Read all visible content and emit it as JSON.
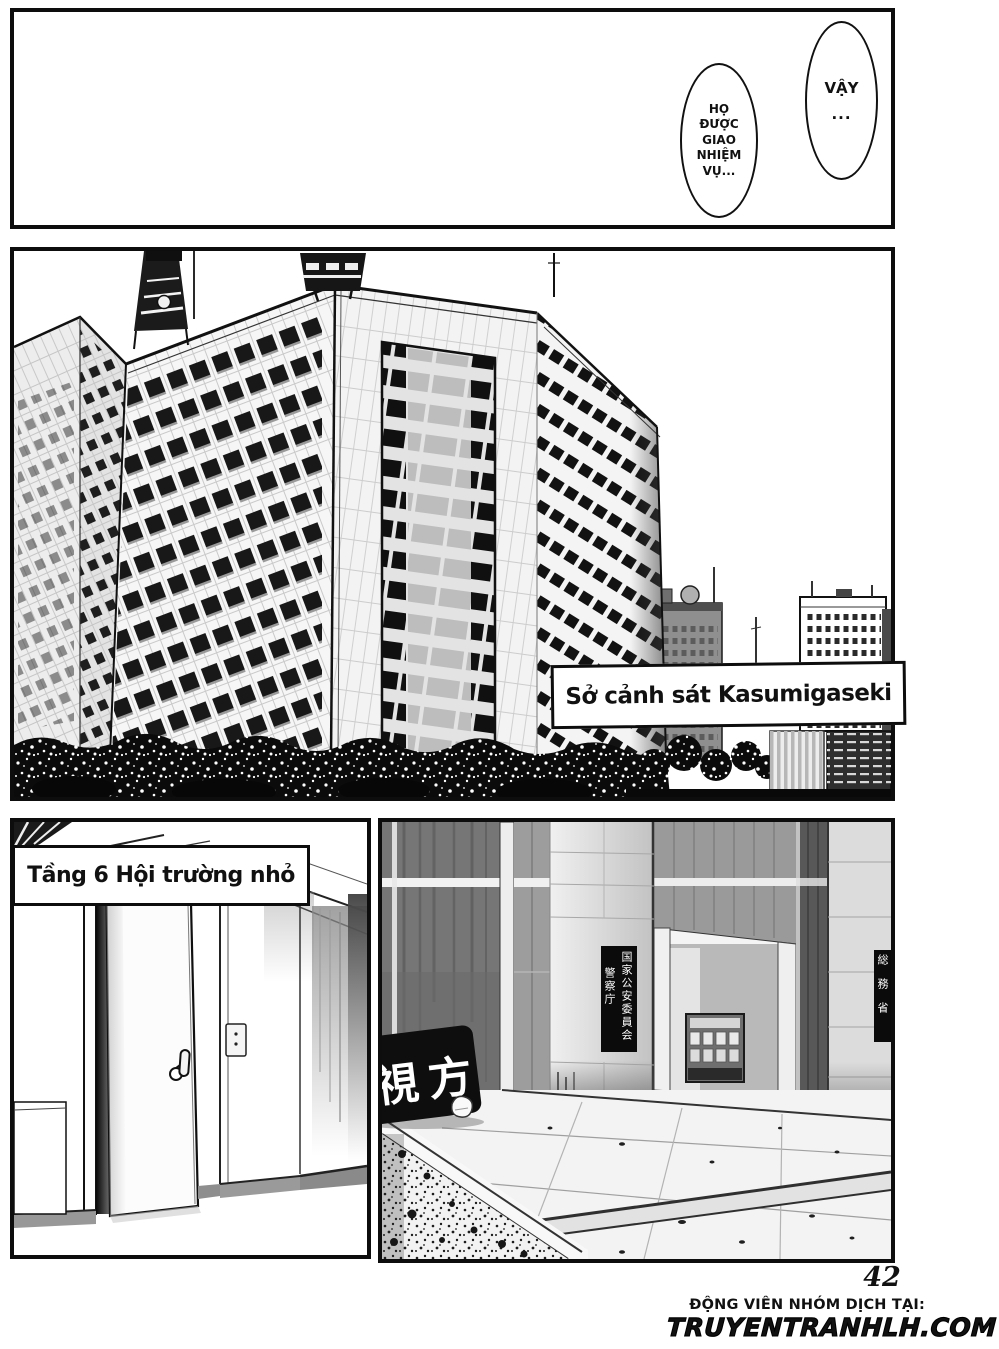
{
  "page": {
    "number": "42"
  },
  "top_panel": {
    "bubble_right": {
      "line1": "VẬY",
      "line2": "..."
    },
    "bubble_left": {
      "line1": "HỌ",
      "line2": "ĐƯỢC",
      "line3": "GIAO",
      "line4": "NHIỆM",
      "line5": "VỤ..."
    }
  },
  "building_panel": {
    "caption": "Sở cảnh sát Kasumigaseki"
  },
  "hallway_panel": {
    "caption": "Tầng 6 Hội trường nhỏ"
  },
  "entrance_panel": {
    "pillar_sign": {
      "column_right": "国家公安委員会",
      "column_left": "警察庁"
    },
    "right_pillar_sign": "総務省",
    "monument_sign": "視方"
  },
  "footer": {
    "credit": "ĐỘNG VIÊN NHÓM DỊCH TẠI:",
    "site": "TRUYENTRANHLH.COM"
  }
}
